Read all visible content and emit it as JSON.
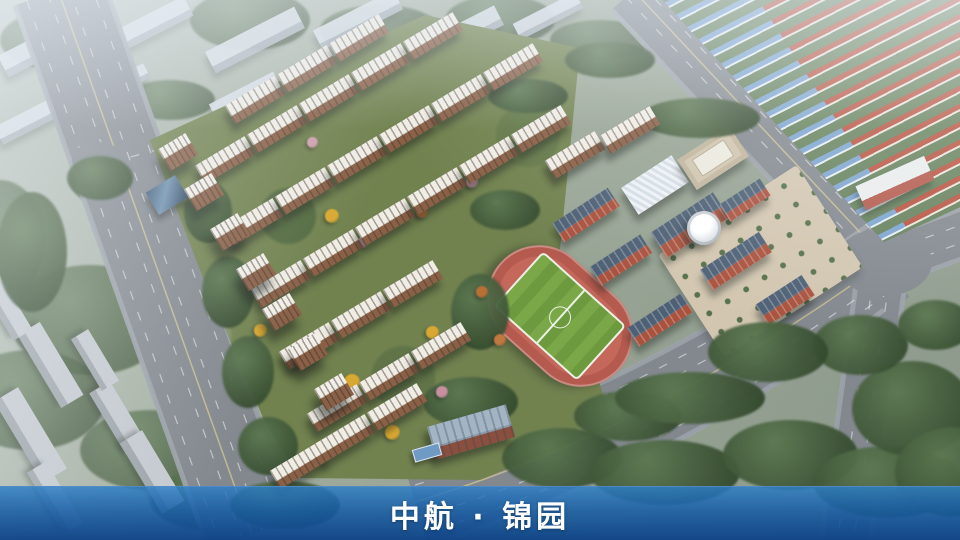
{
  "banner": {
    "title": "中航 · 锦园"
  },
  "palette": {
    "banner_blue": "#1565ab",
    "banner_blue_dark": "#0a4086",
    "road_grey": "#82888e",
    "track_red": "#c4685c",
    "field_green": "#6f9c3f",
    "school_brick": "#a9523e",
    "school_roof": "#4e6075",
    "tower_roof": "#f0ede5",
    "tower_facade": "#8a6047",
    "townhouse_roof_red": "#b8513f",
    "townhouse_roof_blue": "#7ba3cf",
    "tree_green": "#42593a",
    "autumn_yellow": "#d9a832",
    "blossom_pink": "#cf9fae",
    "context_grey": "#c6cfd6"
  }
}
